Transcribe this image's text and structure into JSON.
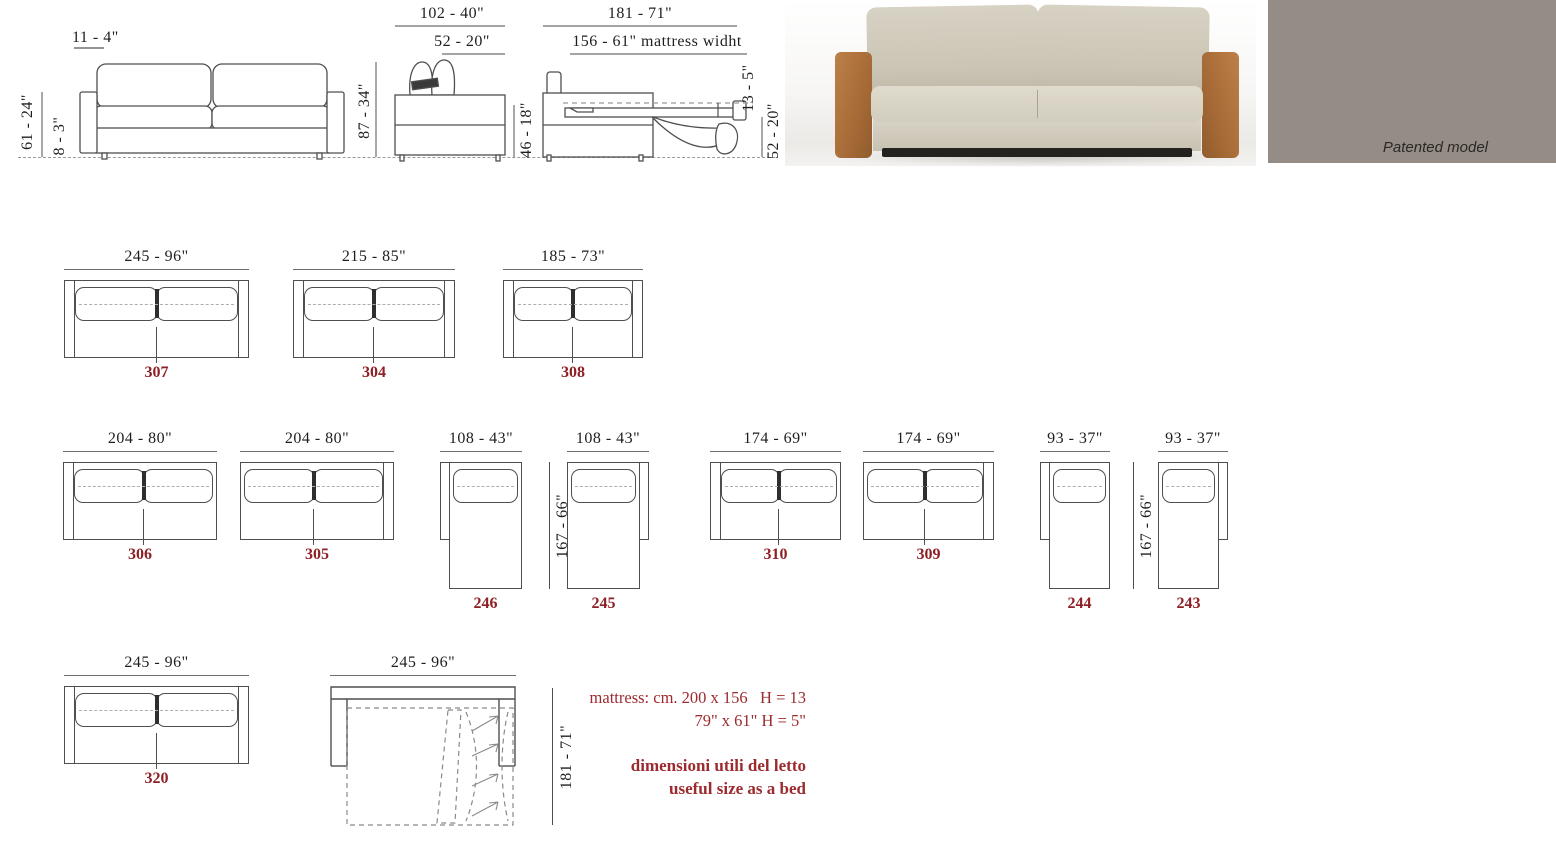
{
  "colors": {
    "line": "#4f4f4f",
    "model_red": "#8e1f24",
    "note_red": "#9c2a2e",
    "panel_bg": "#958c86",
    "sofa_fabric": "#d5d0c2",
    "sofa_leather_arm": "#b0763f"
  },
  "front_view": {
    "arm_width": "11 - 4\"",
    "total_height": "61 - 24\"",
    "base_height": "8 - 3\""
  },
  "side_view": {
    "depth": "102 - 40\"",
    "seat_depth": "52 - 20\"",
    "total_height": "87 - 34\"",
    "body_height": "46 - 18\""
  },
  "bed_side_view": {
    "open_depth": "181 - 71\"",
    "mattress_width": "156 - 61\" mattress widht",
    "mattress_thickness": "13 - 5\"",
    "bed_height": "52 - 20\""
  },
  "patented": {
    "label": "Patented model"
  },
  "rows": [
    {
      "top": 248,
      "units": [
        {
          "model": "307",
          "size": "245 - 96\"",
          "cm": 245,
          "type": "sofa2",
          "arms": "both",
          "x": 64
        },
        {
          "model": "304",
          "size": "215 - 85\"",
          "cm": 215,
          "type": "sofa2",
          "arms": "both",
          "x": 293
        },
        {
          "model": "308",
          "size": "185 - 73\"",
          "cm": 185,
          "type": "sofa2",
          "arms": "both",
          "x": 503
        }
      ]
    },
    {
      "top": 430,
      "units": [
        {
          "model": "306",
          "size": "204 - 80\"",
          "cm": 204,
          "type": "sofa2",
          "arms": "left",
          "x": 63
        },
        {
          "model": "305",
          "size": "204 - 80\"",
          "cm": 204,
          "type": "sofa2",
          "arms": "right",
          "x": 240
        },
        {
          "model": "246",
          "size": "108 - 43\"",
          "cm": 108,
          "type": "chaise",
          "arms": "left",
          "x": 440
        },
        {
          "model": "245",
          "size": "108 - 43\"",
          "cm": 108,
          "type": "chaise",
          "arms": "right",
          "x": 567
        },
        {
          "model": "310",
          "size": "174 - 69\"",
          "cm": 174,
          "type": "sofa2",
          "arms": "left",
          "x": 710
        },
        {
          "model": "309",
          "size": "174 - 69\"",
          "cm": 174,
          "type": "sofa2",
          "arms": "right",
          "x": 863
        },
        {
          "model": "244",
          "size": "93 - 37\"",
          "cm": 93,
          "type": "chaise",
          "arms": "left",
          "x": 1040
        },
        {
          "model": "243",
          "size": "93 - 37\"",
          "cm": 93,
          "type": "chaise",
          "arms": "right",
          "x": 1158
        }
      ]
    },
    {
      "top": 654,
      "units": [
        {
          "model": "320",
          "size": "245 - 96\"",
          "cm": 245,
          "type": "sofa2",
          "arms": "both",
          "x": 64
        }
      ]
    }
  ],
  "vdims": [
    {
      "label": "167 - 66\""
    },
    {
      "label": "167 - 66\""
    },
    {
      "label": "181 - 71\""
    }
  ],
  "bed_open": {
    "size": "245 - 96\""
  },
  "notes": {
    "line1": "mattress: cm. 200 x 156   H = 13",
    "line2": "79\" x 61\" H = 5\"",
    "line3": "dimensioni utili del letto",
    "line4": "useful size as a bed"
  }
}
